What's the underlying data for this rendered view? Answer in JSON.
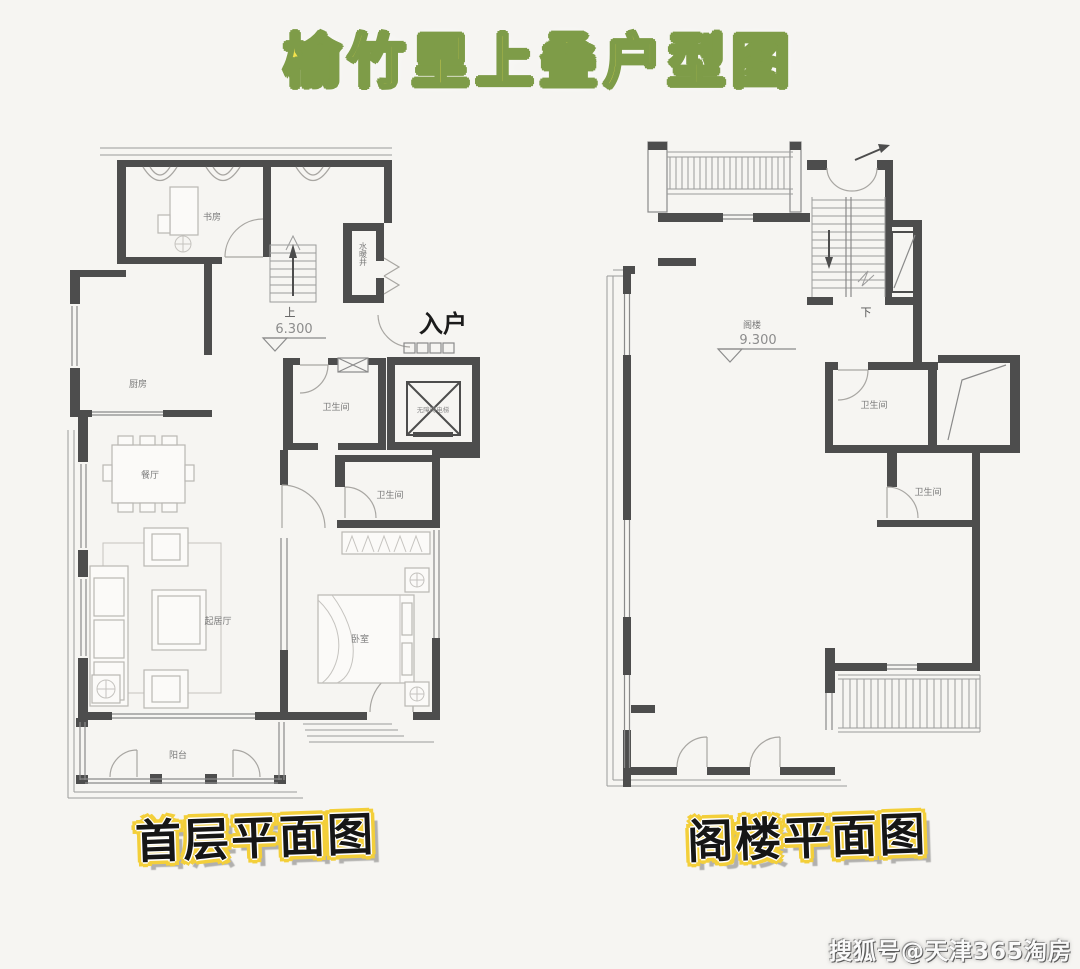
{
  "page": {
    "title": "榆竹里上叠户型图",
    "watermark": "搜狐号@天津365淘房",
    "colors": {
      "background": "#f6f5f2",
      "wall": "#4d4d4d",
      "title_fill": "#f2e24c",
      "title_outline": "#7e9c48",
      "caption_outline": "#f3cf3a"
    }
  },
  "first_floor": {
    "caption": "首层平面图",
    "labels": {
      "study": "书房",
      "utility_shaft": "水暖井",
      "stairs_up": "上",
      "elevation": "6.300",
      "entry": "入户",
      "elevator": "无障碍电梯",
      "kitchen": "厨房",
      "bathroom_upper": "卫生间",
      "bathroom_lower": "卫生间",
      "dining": "餐厅",
      "living": "起居厅",
      "bedroom": "卧室",
      "balcony": "阳台"
    }
  },
  "attic": {
    "caption": "阁楼平面图",
    "labels": {
      "stairs_down": "下",
      "attic": "阁楼",
      "elevation": "9.300",
      "bathroom_upper": "卫生间",
      "bathroom_lower": "卫生间"
    }
  }
}
